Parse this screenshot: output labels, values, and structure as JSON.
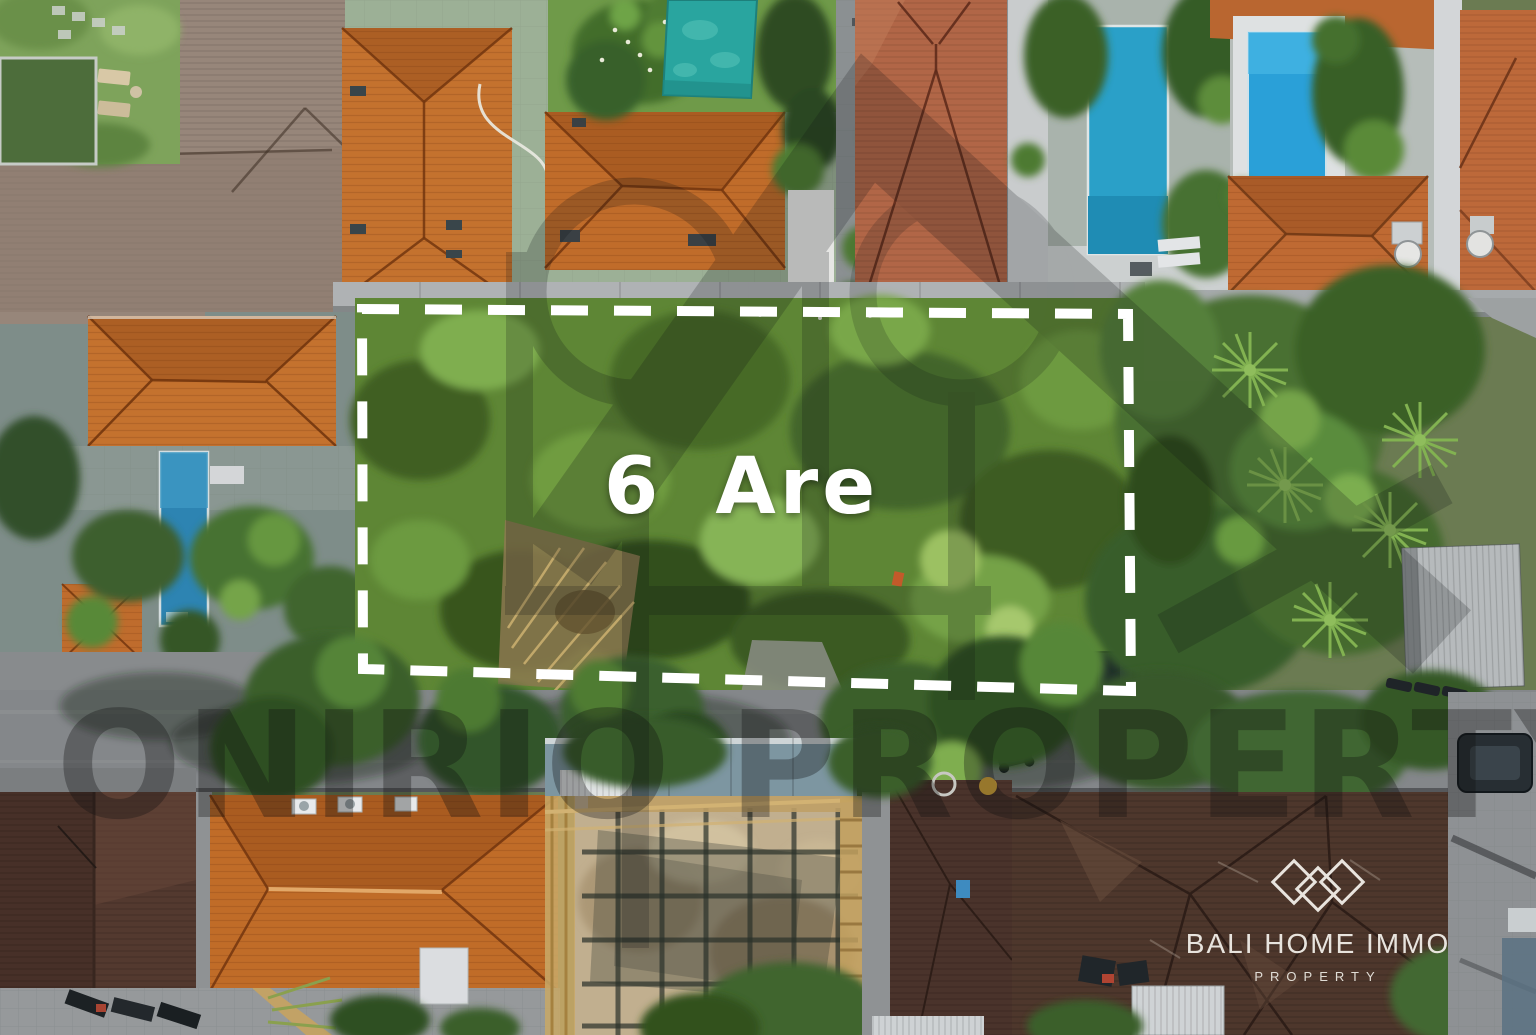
{
  "photo": {
    "description": "aerial drone view of Bali villas and a vacant land plot for sale",
    "plot_area_label": "6 Are"
  },
  "watermark": {
    "text": "ONIRIO PROPERTY",
    "logo_icon": "house-trident-watermark-icon"
  },
  "brand": {
    "name": "BALI HOME IMMO",
    "tagline": "PROPERTY",
    "logo_icon": "triple-diamond-logo-icon"
  },
  "colors": {
    "plot_boundary_dash": "#ffffff",
    "area_label_text": "#ffffff",
    "watermark_tint": "rgba(15,15,15,0.32)",
    "brand_white": "#f1eee8",
    "roof_orange": "#c4722e",
    "roof_red_brown": "#b16647",
    "roof_dark_brown": "#4e372c",
    "roof_weathered_gray": "#97867a",
    "pool_teal": "#29a59f",
    "pool_blue": "#2aa0d8",
    "lap_pool_blue": "#2d84b2",
    "vegetation_green": "#5e8635",
    "deck_pale_green": "#9cb096",
    "road_gray": "#84878a"
  }
}
